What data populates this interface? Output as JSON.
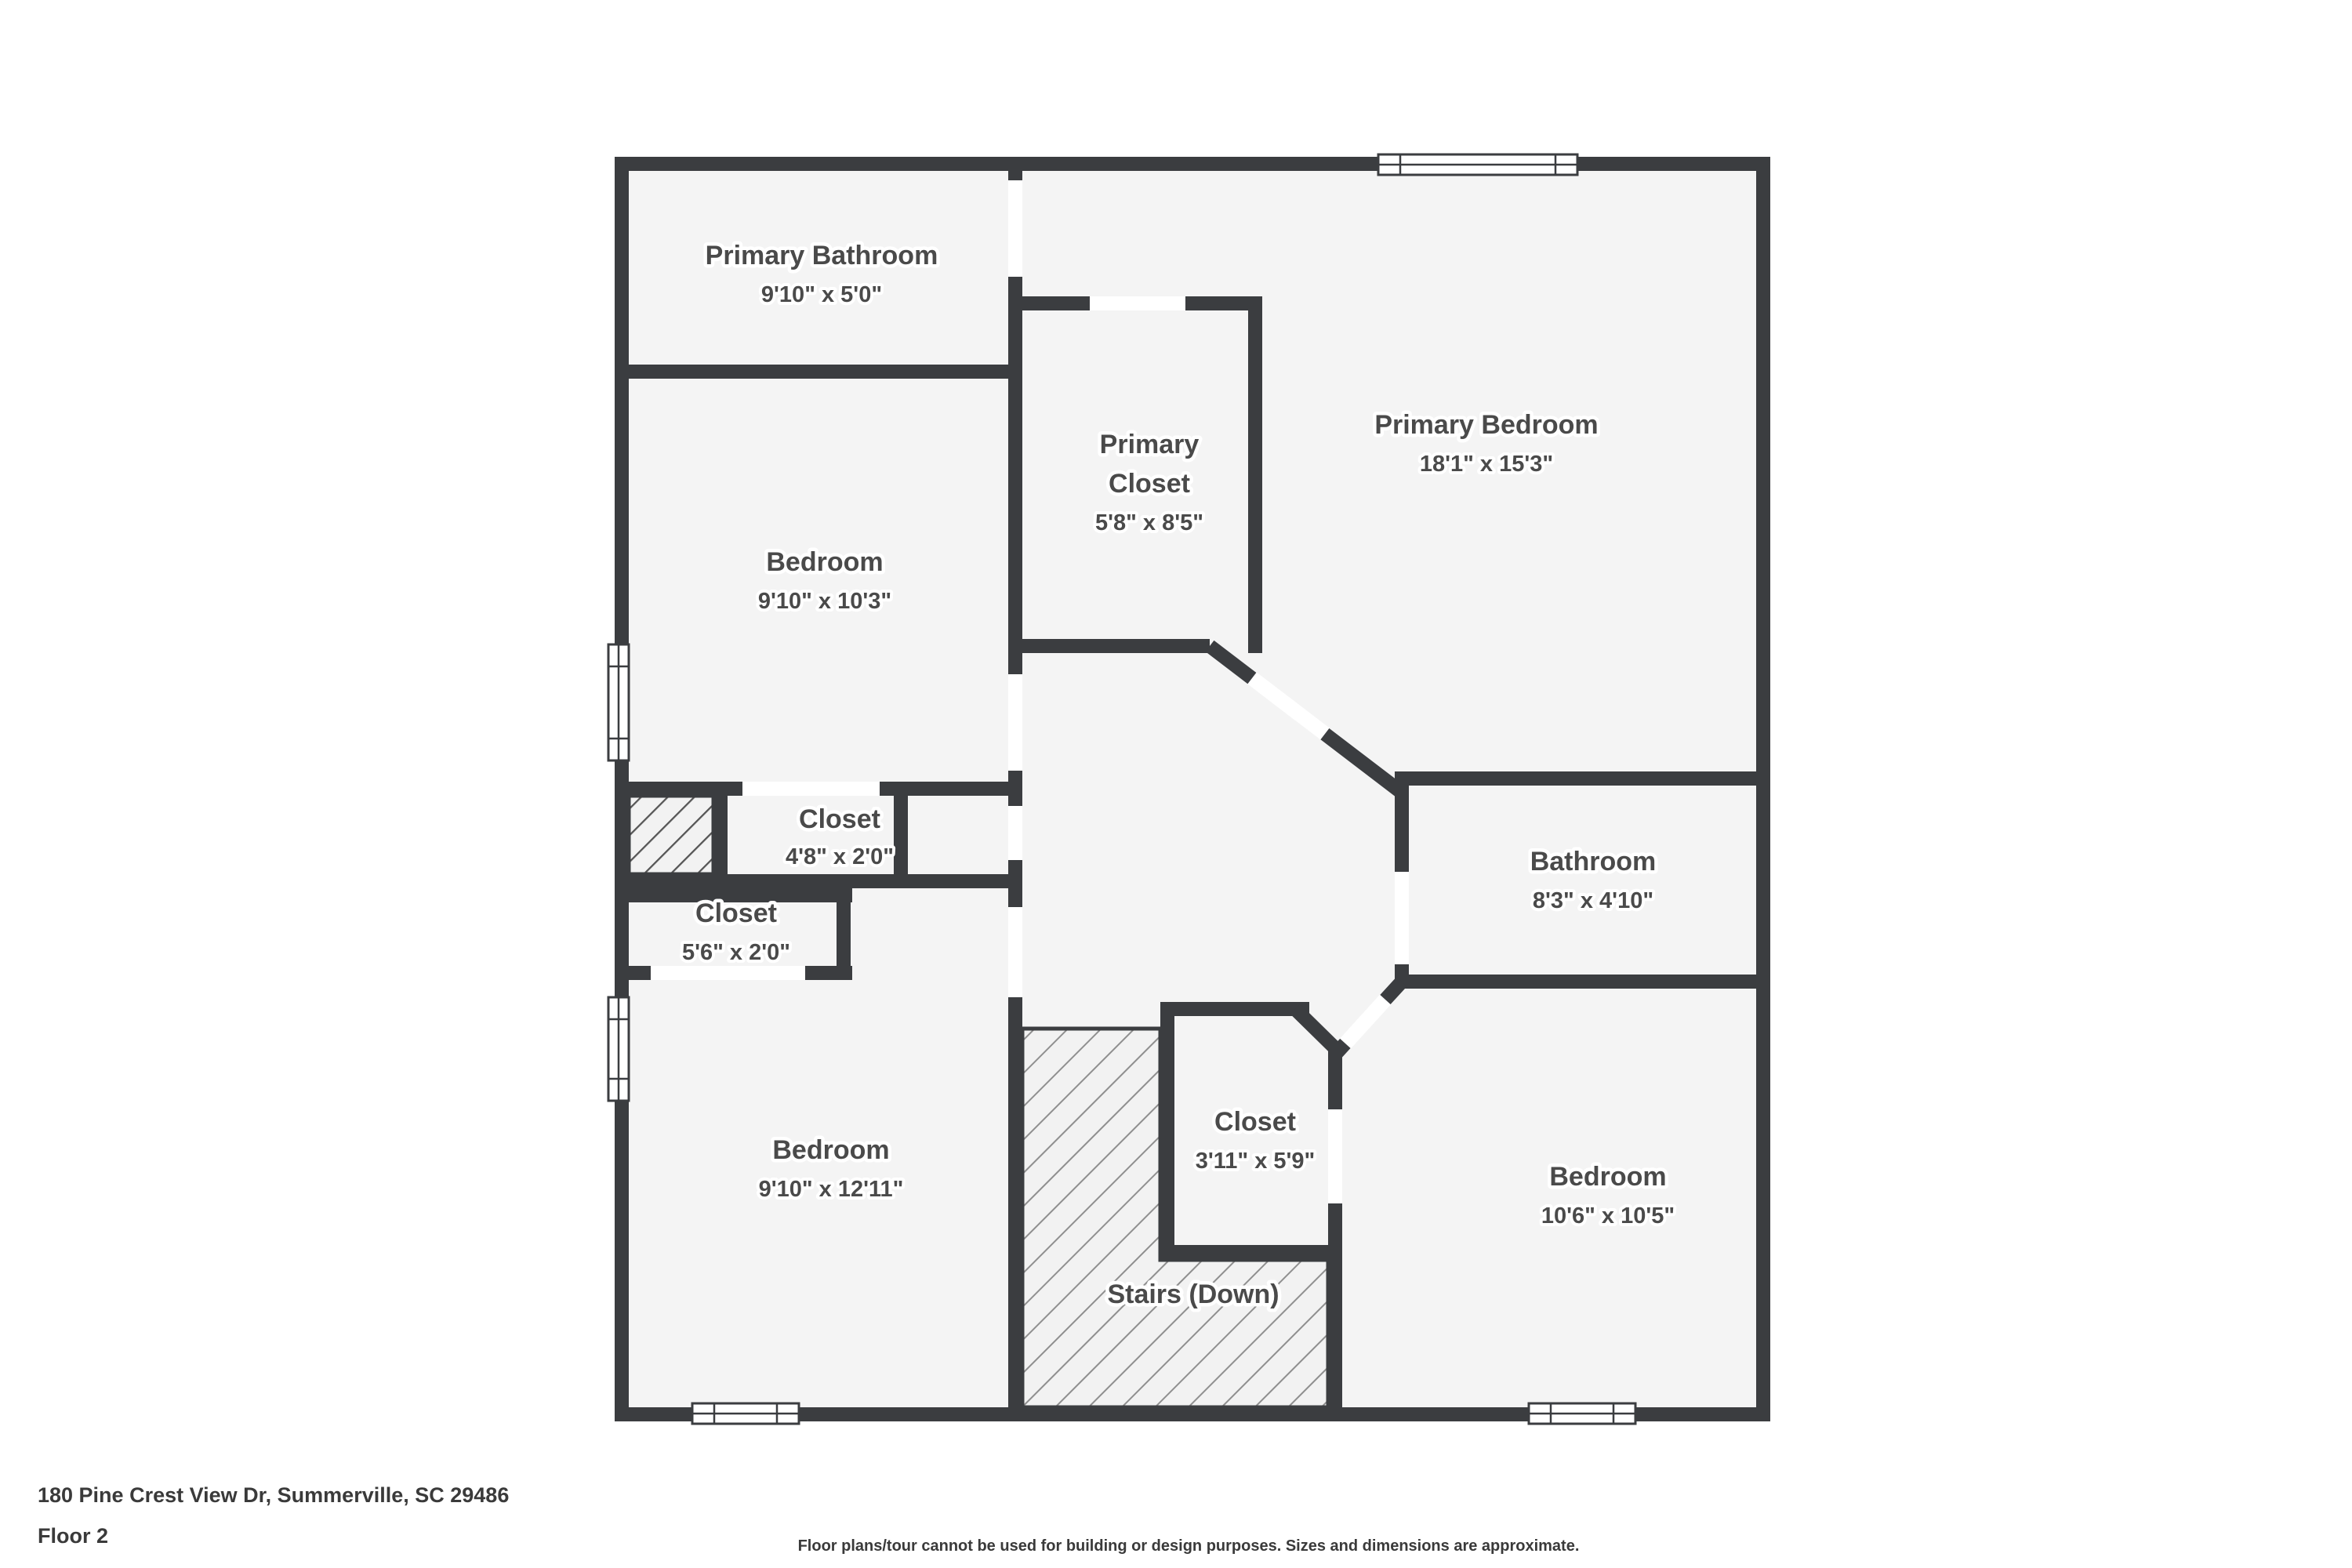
{
  "footer": {
    "address": "180 Pine Crest View Dr, Summerville, SC 29486",
    "floor_label": "Floor 2",
    "disclaimer": "Floor plans/tour cannot be used for building or design purposes. Sizes and dimensions are approximate."
  },
  "rooms": {
    "primary_bathroom": {
      "label": "Primary Bathroom",
      "dims": "9'10\" x 5'0\""
    },
    "primary_closet": {
      "label_line1": "Primary",
      "label_line2": "Closet",
      "dims": "5'8\" x 8'5\""
    },
    "primary_bedroom": {
      "label": "Primary Bedroom",
      "dims": "18'1\" x 15'3\""
    },
    "bedroom_top": {
      "label": "Bedroom",
      "dims": "9'10\" x 10'3\""
    },
    "closet_small": {
      "label": "Closet",
      "dims": "4'8\" x 2'0\""
    },
    "closet_mid": {
      "label": "Closet",
      "dims": "5'6\" x 2'0\""
    },
    "bedroom_bottom_left": {
      "label": "Bedroom",
      "dims": "9'10\" x 12'11\""
    },
    "closet_bottom": {
      "label": "Closet",
      "dims": "3'11\" x 5'9\""
    },
    "bathroom": {
      "label": "Bathroom",
      "dims": "8'3\" x 4'10\""
    },
    "bedroom_bottom_right": {
      "label": "Bedroom",
      "dims": "10'6\" x 10'5\""
    },
    "stairs": {
      "label": "Stairs (Down)"
    }
  },
  "colors": {
    "wall": "#3B3D40",
    "room_fill": "#F4F4F4",
    "label_text": "#4A4A4A",
    "footer_text": "#3A3A3A",
    "stairs_hatch_line": "#8F8F8F",
    "chase_hatch_line": "#555555"
  }
}
